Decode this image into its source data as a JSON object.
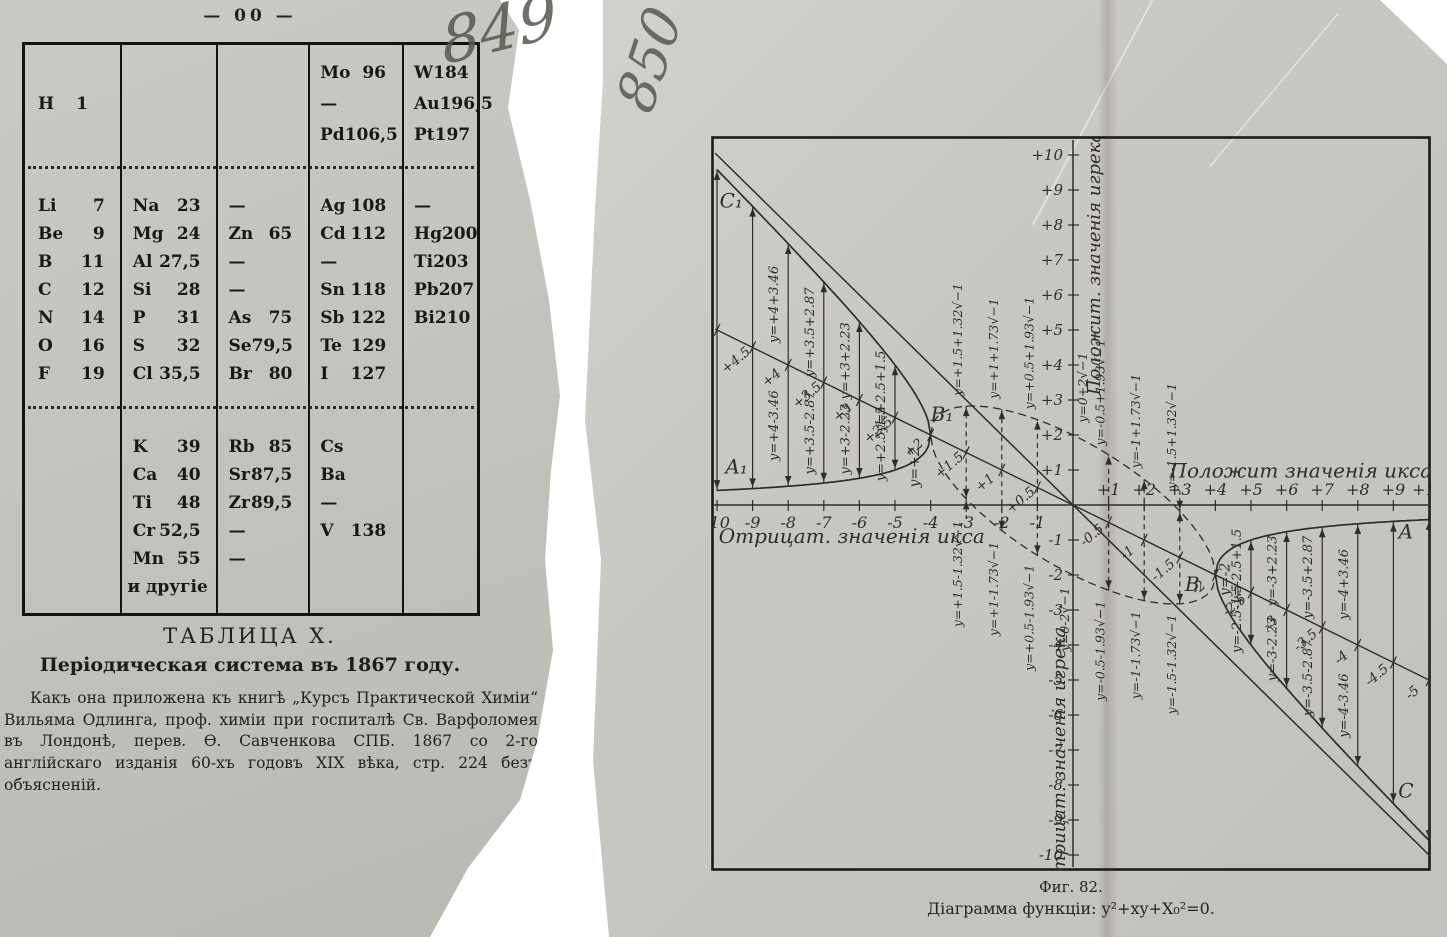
{
  "page_left": {
    "page_number": "— 00 —",
    "handwritten_number": "849",
    "table": {
      "sections": [
        {
          "rows": [
            [
              null,
              null,
              null,
              [
                "Mo",
                "96"
              ],
              [
                "W",
                "184"
              ]
            ],
            [
              [
                "H",
                "1",
                "tight"
              ],
              null,
              null,
              [
                "—",
                ""
              ],
              [
                "Au",
                "196,5"
              ]
            ],
            [
              null,
              null,
              null,
              [
                "Pd",
                "106,5"
              ],
              [
                "Pt",
                "197"
              ]
            ]
          ]
        },
        {
          "rows": [
            [
              [
                "Li",
                "7"
              ],
              [
                "Na",
                "23"
              ],
              [
                "—",
                ""
              ],
              [
                "Ag",
                "108"
              ],
              [
                "—",
                ""
              ]
            ],
            [
              [
                "Be",
                "9"
              ],
              [
                "Mg",
                "24"
              ],
              [
                "Zn",
                "65"
              ],
              [
                "Cd",
                "112"
              ],
              [
                "Hg",
                "200"
              ]
            ],
            [
              [
                "B",
                "11"
              ],
              [
                "Al",
                "27,5"
              ],
              [
                "—",
                ""
              ],
              [
                "—",
                ""
              ],
              [
                "Ti",
                "203"
              ]
            ],
            [
              [
                "C",
                "12"
              ],
              [
                "Si",
                "28"
              ],
              [
                "—",
                ""
              ],
              [
                "Sn",
                "118"
              ],
              [
                "Pb",
                "207"
              ]
            ],
            [
              [
                "N",
                "14"
              ],
              [
                "P",
                "31"
              ],
              [
                "As",
                "75"
              ],
              [
                "Sb",
                "122"
              ],
              [
                "Bi",
                "210"
              ]
            ],
            [
              [
                "O",
                "16"
              ],
              [
                "S",
                "32"
              ],
              [
                "Se",
                "79,5"
              ],
              [
                "Te",
                "129"
              ],
              null
            ],
            [
              [
                "F",
                "19"
              ],
              [
                "Cl",
                "35,5"
              ],
              [
                "Br",
                "80"
              ],
              [
                "I",
                "127"
              ],
              null
            ]
          ]
        },
        {
          "rows": [
            [
              null,
              [
                "K",
                "39"
              ],
              [
                "Rb",
                "85"
              ],
              [
                "Cs",
                ""
              ],
              null
            ],
            [
              null,
              [
                "Ca",
                "40"
              ],
              [
                "Sr",
                "87,5"
              ],
              [
                "Ba",
                ""
              ],
              null
            ],
            [
              null,
              [
                "Ti",
                "48"
              ],
              [
                "Zr",
                "89,5"
              ],
              [
                "—",
                ""
              ],
              null
            ],
            [
              null,
              [
                "Cr",
                "52,5"
              ],
              [
                "—",
                ""
              ],
              [
                "V",
                "138"
              ],
              null
            ],
            [
              null,
              [
                "Mn",
                "55"
              ],
              [
                "—",
                ""
              ],
              null,
              null
            ],
            [
              null,
              [
                "и другіе",
                "",
                "center"
              ],
              null,
              null,
              null
            ]
          ]
        }
      ]
    },
    "caption_title": "ТАБЛИЦА X.",
    "caption_subtitle": "Періодическая система въ 1867 году.",
    "caption_text": "Какъ она приложена къ книгѣ „Курсъ Практической Химіи“ Вильяма Одлинга, проф. химіи при госпиталѣ Св. Варфоломея въ Лондонѣ, перев. Ѳ. Савченкова СПБ. 1867 со 2-го англійскаго изданія 60-хъ годовъ XIX вѣка, стр. 224 безъ объясненій."
  },
  "page_right": {
    "handwritten_number": "850",
    "figure_caption_line1": "Фиг. 82.",
    "figure_caption_line2": "Діаграмма функціи: y²+xy+X₀²=0."
  },
  "chart_data": {
    "type": "diagram",
    "title": "Фиг. 82.",
    "equation": "y²+xy+X₀²=0",
    "x0": 2,
    "xlim": [
      -10,
      10
    ],
    "ylim": [
      -10,
      10
    ],
    "grid": false,
    "axis_labels": {
      "x_pos": "Положит значенія икса",
      "x_neg": "Отрицат. значенія икса",
      "y_pos": "Положит. значенія игрека",
      "y_neg": "Отрицат. значенія игрека"
    },
    "x_ticks_neg": [
      "-10",
      "-9",
      "-8",
      "-7",
      "-6",
      "-5",
      "-4",
      "-3",
      "-2",
      "-1"
    ],
    "x_ticks_pos": [
      "+1",
      "+2",
      "+3",
      "+4",
      "+5",
      "+6",
      "+7",
      "+8",
      "+9",
      "+10"
    ],
    "y_ticks_pos": [
      "+1",
      "+2",
      "+3",
      "+4",
      "+5",
      "+6",
      "+7",
      "+8",
      "+9",
      "+10"
    ],
    "y_ticks_neg": [
      "-1",
      "-2",
      "-3",
      "-4",
      "-5",
      "-6",
      "-7",
      "-8",
      "-9",
      "-10"
    ],
    "half_line_labels": [
      {
        "x": -10,
        "t": "+5"
      },
      {
        "x": -9,
        "t": "+4.5"
      },
      {
        "x": -8,
        "t": "+4"
      },
      {
        "x": -7,
        "t": "+3.5"
      },
      {
        "x": -6,
        "t": "+3"
      },
      {
        "x": -5,
        "t": "+2.5"
      },
      {
        "x": -4,
        "t": "+2"
      },
      {
        "x": -3,
        "t": "+1.5"
      },
      {
        "x": -2,
        "t": "+1"
      },
      {
        "x": -1,
        "t": "+0.5"
      },
      {
        "x": 1,
        "t": "-0.5"
      },
      {
        "x": 2,
        "t": "-1"
      },
      {
        "x": 3,
        "t": "-1.5"
      },
      {
        "x": 4,
        "t": "-2"
      },
      {
        "x": 5,
        "t": "-2.5"
      },
      {
        "x": 6,
        "t": "-3"
      },
      {
        "x": 7,
        "t": "-3.5"
      },
      {
        "x": 8,
        "t": "-4"
      },
      {
        "x": 9,
        "t": "-4.5"
      },
      {
        "x": 10,
        "t": "-5"
      }
    ],
    "real_arrows": [
      {
        "x": -10
      },
      {
        "x": -9
      },
      {
        "x": -8,
        "upper": "y=+4+3.46",
        "lower": "y=+4-3.46"
      },
      {
        "x": -7,
        "upper": "y=+3.5+2.87",
        "lower": "y=+3.5-2.87"
      },
      {
        "x": -6,
        "upper": "y=+3+2.23",
        "lower": "y=+3-2.23"
      },
      {
        "x": -5,
        "upper": "y=+2.5+1.5",
        "lower": "y=+2.5-1.5"
      },
      {
        "x": 5,
        "upper": "y=-2.5+1.5",
        "lower": "y=-2.5-1.5"
      },
      {
        "x": 6,
        "upper": "y=-3+2.23",
        "lower": "y=-3-2.23"
      },
      {
        "x": 7,
        "upper": "y=-3.5+2.87",
        "lower": "y=-3.5-2.87"
      },
      {
        "x": 8,
        "upper": "y=-4+3.46",
        "lower": "y=-4-3.46"
      },
      {
        "x": 9
      },
      {
        "x": 10
      }
    ],
    "complex_labels": [
      {
        "x": -3,
        "upper": "y=+1.5+1.32√−1",
        "lower": "y=+1.5-1.32√−1"
      },
      {
        "x": -2,
        "upper": "y=+1+1.73√−1",
        "lower": "y=+1-1.73√−1"
      },
      {
        "x": -1,
        "upper": "y=+0.5+1.93√−1",
        "lower": "y=+0.5-1.93√−1"
      },
      {
        "x": 0,
        "upper": "y=0+2√−1",
        "lower": "y=0-2√−1"
      },
      {
        "x": 1,
        "upper": "y=-0.5+1.93√−1",
        "lower": "y=-0.5-1.93√−1"
      },
      {
        "x": 2,
        "upper": "y=-1+1.73√−1",
        "lower": "y=-1-1.73√−1"
      },
      {
        "x": 3,
        "upper": "y=-1.5+1.32√−1",
        "lower": "y=-1.5-1.32√−1"
      }
    ],
    "vertex_labels": [
      {
        "t": "y=+2",
        "x": -4.33,
        "y": 0.5
      },
      {
        "t": "y=-2",
        "x": 4.4,
        "y": -2.6
      }
    ],
    "point_labels": [
      {
        "t": "C₁",
        "x": -9.6,
        "y": 8.5
      },
      {
        "t": "A₁",
        "x": -9.45,
        "y": 0.9
      },
      {
        "t": "B₁",
        "x": -3.68,
        "y": 2.4
      },
      {
        "t": "B",
        "x": 3.35,
        "y": -2.45
      },
      {
        "t": "A",
        "x": 9.35,
        "y": -0.95
      },
      {
        "t": "C",
        "x": 9.35,
        "y": -8.35
      }
    ],
    "key_points": {
      "B1": [
        -4,
        2
      ],
      "B": [
        4,
        -2
      ],
      "lines": [
        "y=-x",
        "y=-x/2"
      ],
      "real_branch_domain": "|x|>=4",
      "complex_ellipse": "y=-x/2±√(16-x²)/2 (dashed)"
    }
  }
}
